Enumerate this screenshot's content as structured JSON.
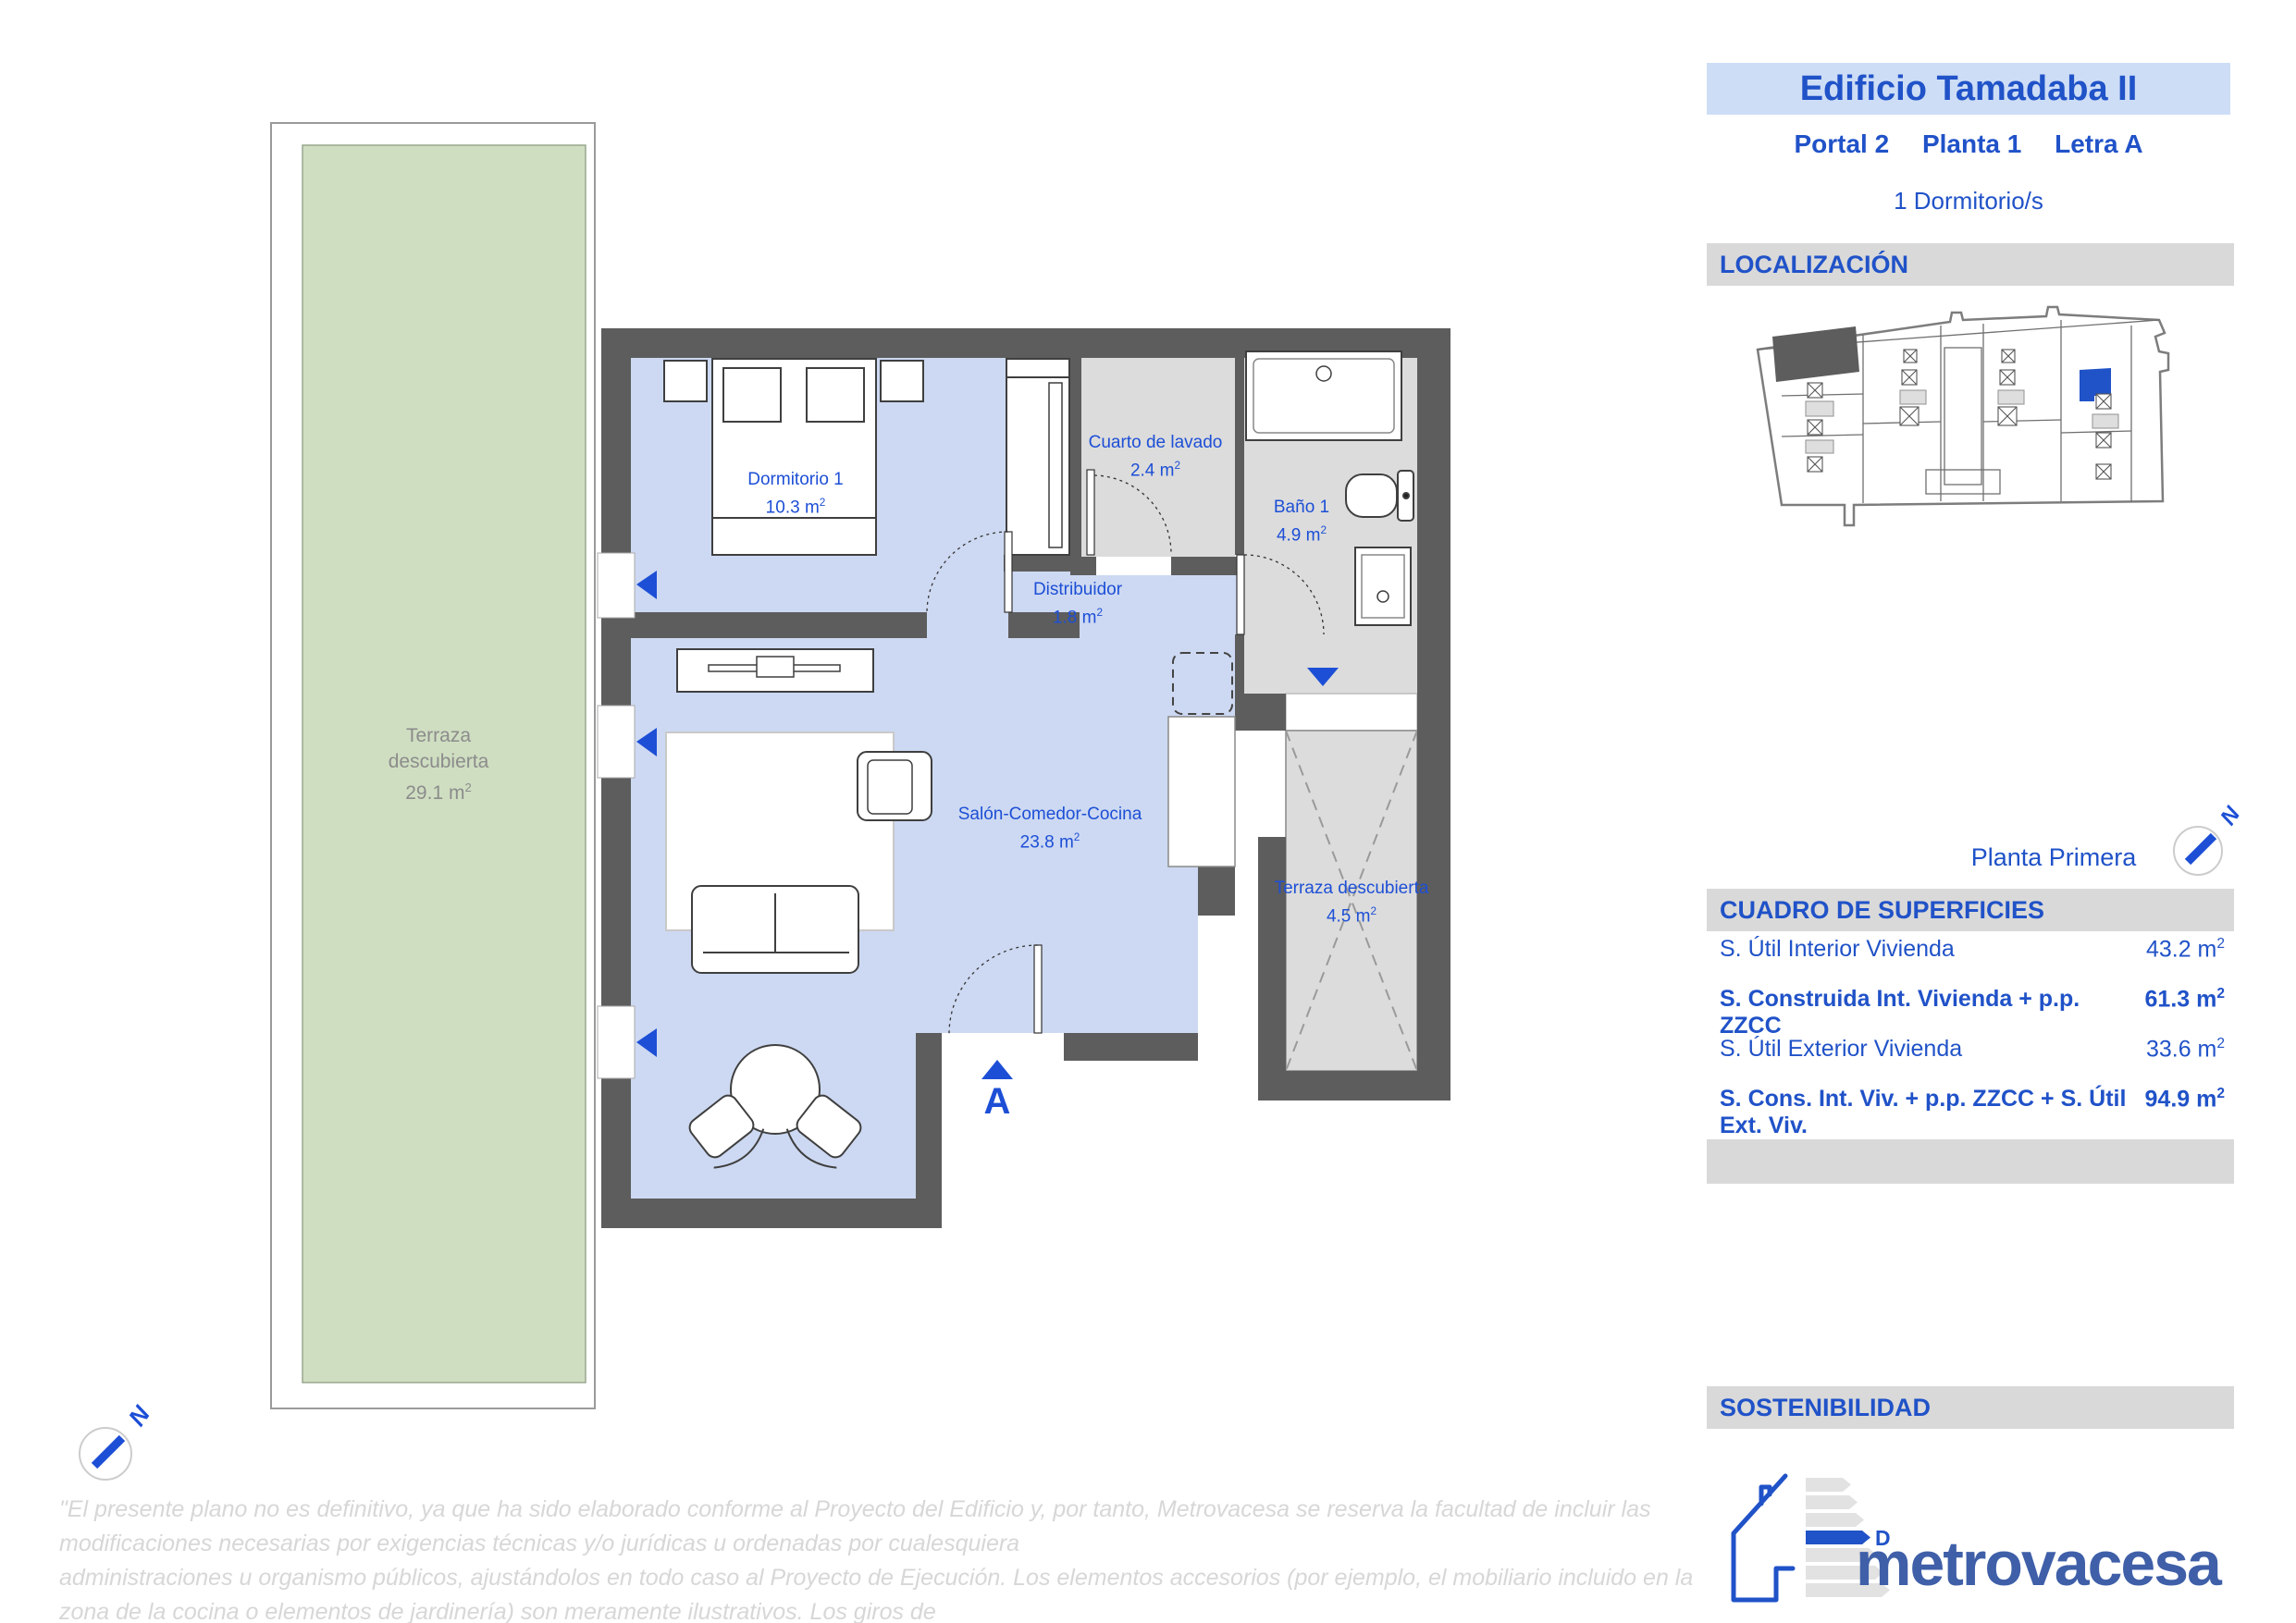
{
  "header": {
    "building_name": "Edificio Tamadaba II",
    "portal": "Portal 2",
    "planta": "Planta 1",
    "letra": "Letra A",
    "bedrooms_line": "1 Dormitorio/s"
  },
  "sections": {
    "localizacion": "LOCALIZACIÓN",
    "cuadro": "CUADRO DE SUPERFICIES",
    "sostenibilidad": "SOSTENIBILIDAD"
  },
  "plan": {
    "floor_label": "Planta Primera",
    "north": "N",
    "entrance_marker": "A",
    "unit": "m",
    "sup": "2",
    "rooms": [
      {
        "id": "dormitorio-1",
        "name": "Dormitorio 1",
        "area": "10.3"
      },
      {
        "id": "cuarto-de-lavado",
        "name": "Cuarto de lavado",
        "area": "2.4"
      },
      {
        "id": "bano-1",
        "name": "Baño 1",
        "area": "4.9"
      },
      {
        "id": "distribuidor",
        "name": "Distribuidor",
        "area": "1.8"
      },
      {
        "id": "salon-comedor-cocina",
        "name": "Salón-Comedor-Cocina",
        "area": "23.8"
      },
      {
        "id": "terraza-descubierta",
        "name": "Terraza descubierta",
        "area": "4.5"
      },
      {
        "id": "terraza-descubierta-grande",
        "name_line1": "Terraza",
        "name_line2": "descubierta",
        "area": "29.1"
      }
    ]
  },
  "superficies": {
    "rows": [
      {
        "label": "S. Útil Interior Vivienda",
        "value": "43.2",
        "bold": false
      },
      {
        "label": "S. Construida Int. Vivienda + p.p. ZZCC",
        "value": "61.3",
        "bold": true
      },
      {
        "label": "S. Útil Exterior Vivienda",
        "value": "33.6",
        "bold": false
      },
      {
        "label": "S. Cons. Int. Viv. + p.p. ZZCC + S. Útil Ext. Viv.",
        "value": "94.9",
        "bold": true
      }
    ]
  },
  "energy": {
    "rating": "D"
  },
  "brand": {
    "logo_text": "metrovacesa"
  },
  "disclaimer": {
    "lines": [
      "\"El presente plano no es definitivo, ya que ha sido elaborado conforme al Proyecto del Edificio y, por tanto, Metrovacesa se reserva la facultad de incluir las modificaciones necesarias por exigencias técnicas y/o jurídicas u ordenadas por cualesquiera",
      "administraciones u organismo públicos, ajustándolos en todo caso al Proyecto de Ejecución. Los elementos accesorios (por ejemplo, el mobiliario incluido en la zona de la cocina o elementos de jardinería) son meramente ilustrativos. Los giros de",
      "puertas y la distribución de aparatos sanitarios no son vinculantes. Las superficies expresadas son aproximadas, pudiendo experimentar modificaciones por razones de índole técnico y/o legal en el desarrollo de la ejecución de las obras\"."
    ]
  },
  "colors": {
    "accent": "#2052c8",
    "plan_blue": "#1d4fd6",
    "wall": "#5d5d5d",
    "floor_blue": "#cdd9f2",
    "floor_gray": "#dcdcdc",
    "terrace_green": "#cfdec1",
    "bar_bg": "#d9d9d9",
    "title_bg": "#cdddf6",
    "logo_blue": "#3f5fa8",
    "label_gray": "#8c8c8c",
    "disclaimer_gray": "#d7d7d7"
  }
}
